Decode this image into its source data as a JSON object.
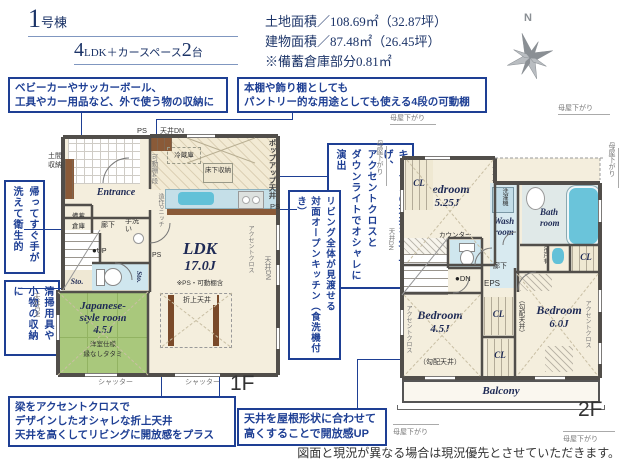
{
  "header": {
    "bldg_num": "1",
    "bldg_suffix": "号棟",
    "plan_num": "4",
    "plan_mid": "LDK＋カースペース",
    "plan_num2": "2",
    "plan_suffix": "台",
    "land": "土地面積／108.69㎡（32.87坪）",
    "building": "建物面積／87.48㎡（26.45坪）",
    "note": "※備蓄倉庫部分0.81㎡",
    "north": "N"
  },
  "ann": {
    "outdoor": [
      "ベビーカーやサッカーボール、",
      "工具やカー用品など、外で使う物の収納に"
    ],
    "shelf": [
      "本棚や飾り棚としても",
      "パントリー的な用途としても使える4段の可動棚"
    ],
    "hand": [
      "帰ってすぐ手が",
      "洗えて衛生的"
    ],
    "clean": [
      "清掃用具や",
      "小物の収納に"
    ],
    "kitchen": [
      "キッチンの天井を少し下げ、",
      "アクセントクロスと",
      "ダウンライトでオシャレに演出"
    ],
    "open": [
      "リビング全体が見渡せる",
      "対面オープンキッチン（食洗機付き）"
    ],
    "beam": [
      "梁をアクセントクロスで",
      "デザインしたオシャレな折上天井",
      "天井を高くしてリビングに開放感をプラス"
    ],
    "slope": [
      "天井を屋根形状に合わせて",
      "高くすることで開放感UP"
    ]
  },
  "f1": {
    "label": "1F",
    "ps": "PS",
    "ten_dn": "天井DN",
    "doma1": "土間",
    "doma2": "収納",
    "kadou": "可動棚4段",
    "fridge": "冷蔵庫",
    "yukashita": "床下収納",
    "niche": "造作Pニッチ",
    "popup": "ポップアップ天井",
    "entrance": "Entrance",
    "rouka": "廊下",
    "tearai": "手洗い",
    "up": "UP",
    "sto": "Sto.",
    "bichiku1": "備蓄",
    "bichiku2": "倉庫",
    "ldk": "LDK",
    "ldk_size": "17.0J",
    "ldk_note": "※PS・可動棚含",
    "accent": "アクセントクロス",
    "oriage": "折上天井",
    "jp1": "Japanese-",
    "jp2": "style room",
    "jp_size": "4.5J",
    "jp_note1": "洋室仕様",
    "jp_note2": "縁なしタタミ",
    "shutter": "シャッター"
  },
  "f2": {
    "label": "2F",
    "moya": "母屋下がり",
    "cl": "CL",
    "bed": "Bedroom",
    "b1_size": "5.25J",
    "b2_size": "4.5J",
    "b3_size": "6.0J",
    "accent": "アクセントクロス",
    "washer": "洗濯機",
    "wash1": "Wash",
    "wash2": "room",
    "bath1": "Bath",
    "bath2": "room",
    "tsurido": "吊戸有",
    "counter": "カウンター",
    "ten_dn": "天井DN",
    "dn": "DN",
    "rouka": "廊下",
    "eps": "EPS",
    "kobai": "（勾配天井）",
    "balcony": "Balcony"
  },
  "footer": {
    "disclaimer": "図面と現況が異なる場合は現況優先とさせていただきます。"
  }
}
